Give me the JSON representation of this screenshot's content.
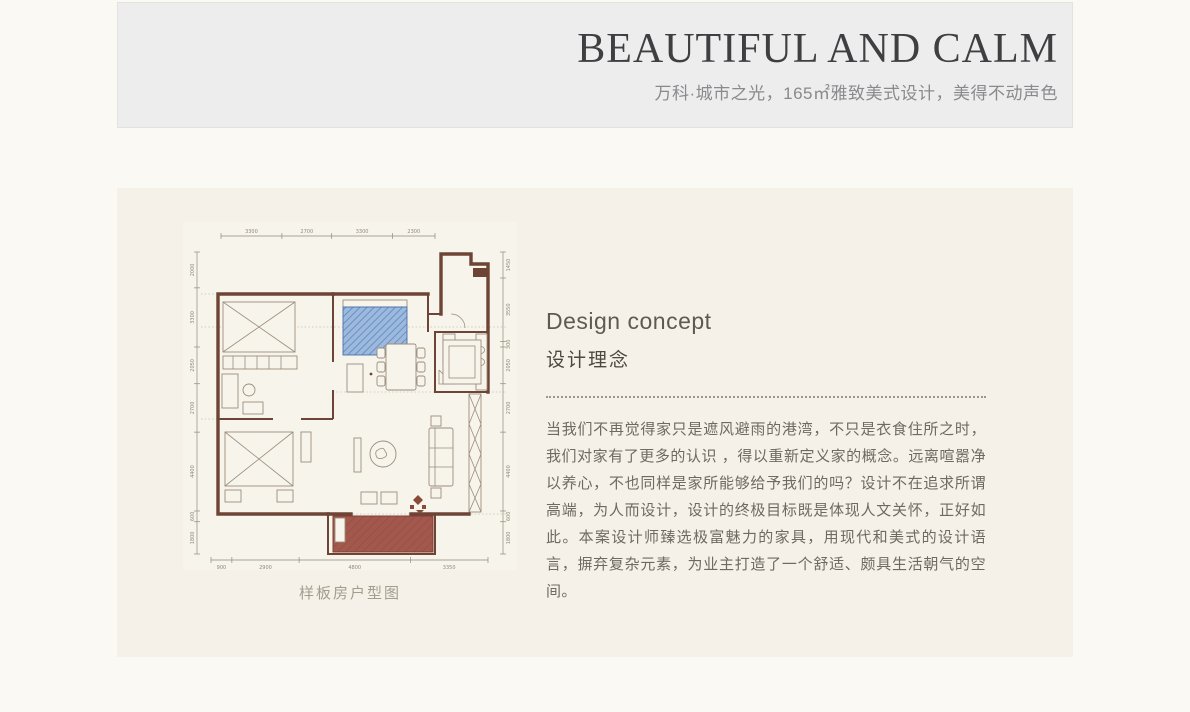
{
  "header": {
    "title": "BEAUTIFUL AND CALM",
    "subtitle": "万科·城市之光，165㎡雅致美式设计，美得不动声色"
  },
  "concept": {
    "title_en": "Design concept",
    "title_zh": "设计理念",
    "body": "当我们不再觉得家只是遮风避雨的港湾，不只是衣食住所之时，我们对家有了更多的认识 ，得以重新定义家的概念。远离喧嚣净以养心，不也同样是家所能够给予我们的吗？设计不在追求所谓高端，为人而设计，设计的终极目标既是体现人文关怀，正好如此。本案设计师臻选极富魅力的家具，用现代和美式的设计语言，摒弃复杂元素，为业主打造了一个舒适、颇具生活朝气的空间。"
  },
  "floorplan": {
    "caption": "样板房户型图",
    "dimensions": {
      "top": [
        3300,
        2700,
        3300,
        2300
      ],
      "bottom": [
        900,
        2900,
        4800,
        3350
      ],
      "left": [
        2000,
        3300,
        2050,
        2700,
        4400,
        600,
        1800
      ],
      "right": [
        1450,
        3550,
        300,
        2050,
        2700,
        4400,
        600,
        1800
      ]
    }
  },
  "colors": {
    "wall_brown": "#6e4434",
    "bed_blue": "#9db9dd",
    "balcony_red": "#a3584e",
    "band_gray": "#ededee",
    "band_beige": "#f5f1e8"
  }
}
